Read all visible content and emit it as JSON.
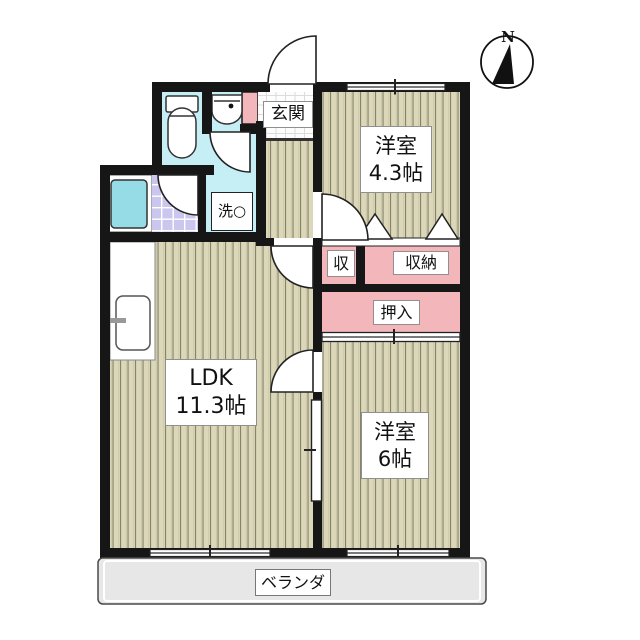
{
  "plan_title": "2LDK floor plan",
  "compass": {
    "label": "N"
  },
  "rooms": {
    "genkan": {
      "label": "玄関"
    },
    "western_4_3": {
      "name": "洋室",
      "size": "4.3帖"
    },
    "storage_small": {
      "label": "収"
    },
    "storage": {
      "label": "収納"
    },
    "oshiire": {
      "label": "押入"
    },
    "laundry": {
      "label": "洗○"
    },
    "ldk": {
      "name": "LDK",
      "size": "11.3帖"
    },
    "western_6": {
      "name": "洋室",
      "size": "6帖"
    },
    "veranda": {
      "label": "ベランダ"
    }
  },
  "colors": {
    "wall": "#161616",
    "wood_floor": "#dbd7b8",
    "closet_pink": "#f3b6ba",
    "water_cyan": "#c5eff5",
    "bath_tile_purple": "#cac6ee",
    "bathtub_cyan": "#96dce7",
    "veranda_gray": "#e7e7e7"
  }
}
